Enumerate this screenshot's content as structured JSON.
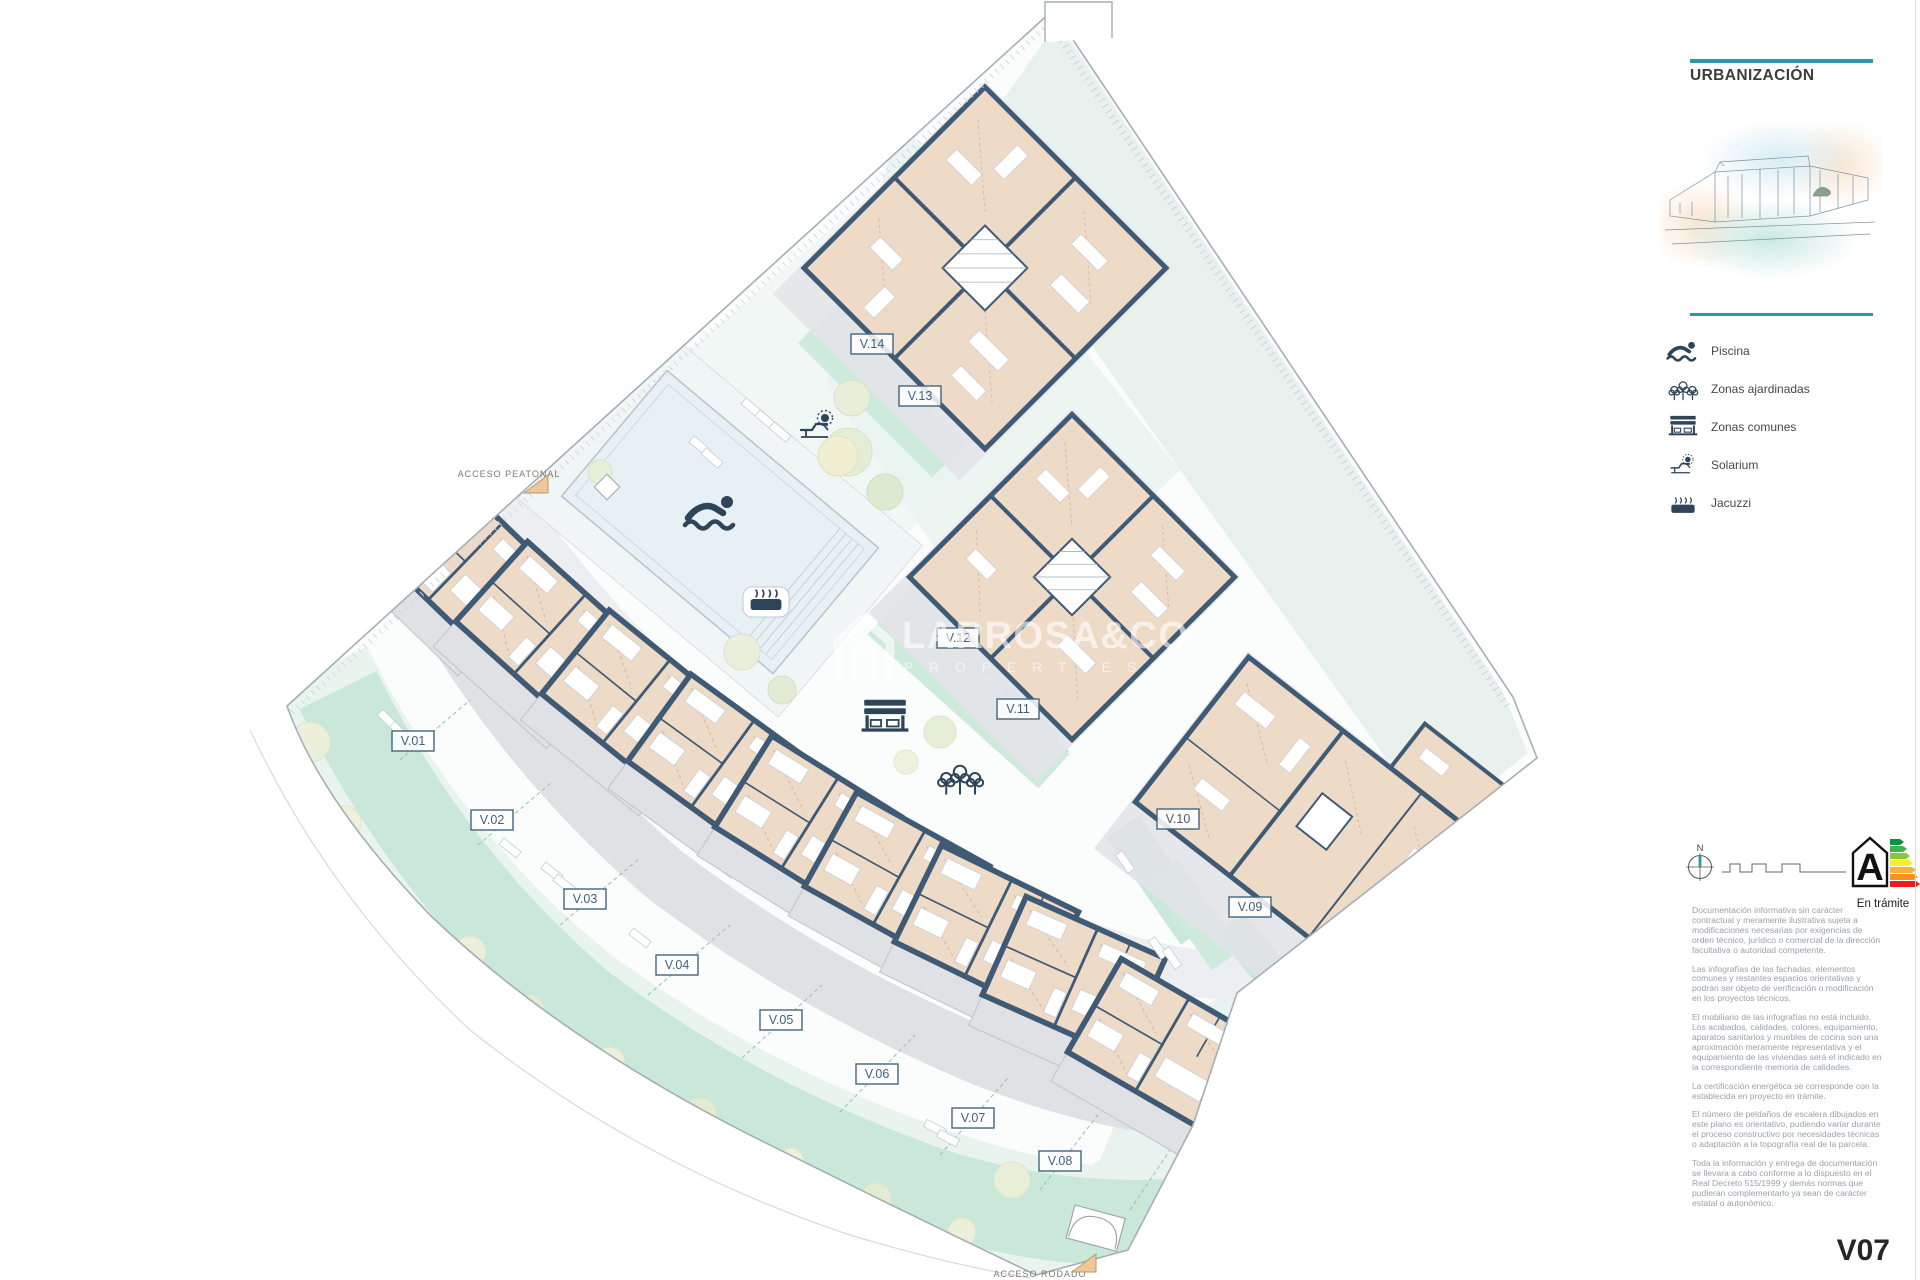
{
  "panel": {
    "title": "URBANIZACIÓN",
    "legend": [
      {
        "icon": "pool-icon",
        "label": "Piscina"
      },
      {
        "icon": "trees-icon",
        "label": "Zonas ajardinadas"
      },
      {
        "icon": "bench-icon",
        "label": "Zonas comunes"
      },
      {
        "icon": "solarium-icon",
        "label": "Solarium"
      },
      {
        "icon": "jacuzzi-icon",
        "label": "Jacuzzi"
      }
    ],
    "compass_label": "N",
    "energy": {
      "letter": "A",
      "status": "En trámite",
      "colors": [
        "#009245",
        "#39b54a",
        "#8cc63f",
        "#f9ed32",
        "#fbb03b",
        "#f7931e",
        "#ed1c24"
      ]
    },
    "disclaimer": [
      "Documentación informativa sin carácter contractual y meramente ilustrativa sujeta a modificaciones necesarias por exigencias de orden técnico, jurídico o comercial de la dirección facultativa o autoridad competente.",
      "Las infografías de las fachadas, elementos comunes y restantes espacios orientativas y podrán ser objeto de verificación o modificación en los proyectos técnicos.",
      "El mobiliario de las infografías no está incluido. Los acabados, calidades, colores, equipamiento, aparatos sanitarios y muebles de cocina son una aproximación meramente representativa y el equipamiento de las viviendas será el indicado en la correspondiente memoria de calidades.",
      "La certificación energética se corresponde con la establecida en proyecto en trámite.",
      "El número de peldaños de escalera dibujados en este plano es orientativo, pudiendo variar durante el proceso constructivo por necesidades técnicas o adaptación a la topografía real de la parcela.",
      "Toda la información y entrega de documentación se llevara a cabo conforme a lo dispuesto en el Real Decreto 515/1999 y demás normas que pudieran complementarlo ya sean de carácter estatal o autonómico."
    ],
    "sheet_code": "V07"
  },
  "plan": {
    "villas": [
      "V.01",
      "V.02",
      "V.03",
      "V.04",
      "V.05",
      "V.06",
      "V.07",
      "V.08",
      "V.09",
      "V.10",
      "V.11",
      "V.12",
      "V.13",
      "V.14"
    ],
    "access_pedestrian": "ACCESO PEATONAL",
    "access_road": "ACCESO RODADO",
    "watermark": {
      "line1": "LARROSA&CO",
      "line2": "P R O P E R T I E S"
    },
    "colors": {
      "accent_teal": "#2b9aa6",
      "wall_navy": "#3e5a75",
      "building_tan": "#eddac7",
      "garden_mint": "#c9e8d9",
      "zone_teal": "#e4efeb",
      "terrace_gray": "#e0e1e5"
    }
  }
}
